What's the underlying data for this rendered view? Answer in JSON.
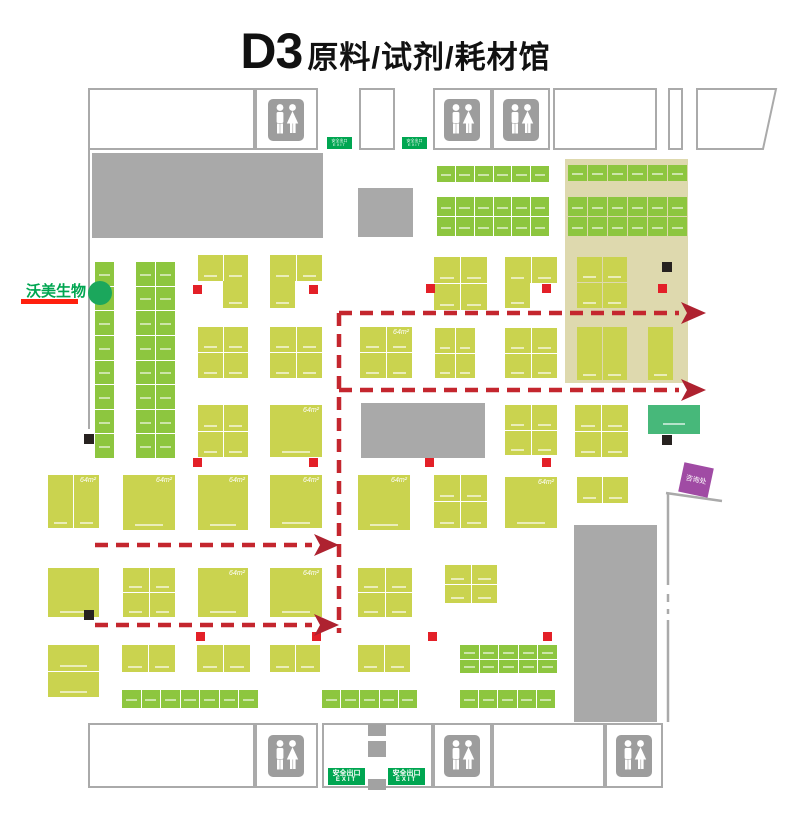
{
  "title": {
    "code": "D3",
    "name": "原料/试剂/耗材馆"
  },
  "exhibitor_marker": {
    "label": "沃美生物",
    "dot_color": "#1ba75c",
    "underline_color": "#ff200e",
    "text_color": "#00a651"
  },
  "info_booth": {
    "label": "咨询处",
    "color": "#a04ba4"
  },
  "exit_sign": {
    "line1": "安全出口",
    "line2": "EXIT",
    "color": "#00a651"
  },
  "area_label": "64m²",
  "icons": {
    "restroom": "male-female-restroom-icon"
  },
  "colors": {
    "booth_green": "#8dc63f",
    "booth_lime": "#cad34f",
    "highlight_zone": "#ded9ae",
    "structure_gray": "#a9a9a9",
    "wall": "#aaaaaa",
    "route_red": "#c4262e",
    "marker_red": "#e32028",
    "marker_black": "#272220",
    "teal_booth": "#47b87a"
  },
  "map_layout": {
    "canvas": {
      "w": 791,
      "h": 817
    },
    "outline_boxes": [
      [
        88,
        88,
        167,
        62
      ],
      [
        255,
        88,
        63,
        62
      ],
      [
        359,
        88,
        36,
        62
      ],
      [
        433,
        88,
        59,
        62
      ],
      [
        492,
        88,
        58,
        62
      ],
      [
        553,
        88,
        104,
        62
      ],
      [
        668,
        88,
        15,
        62
      ],
      [
        88,
        723,
        167,
        65
      ],
      [
        255,
        723,
        63,
        65
      ],
      [
        322,
        723,
        111,
        65
      ],
      [
        433,
        723,
        59,
        65
      ],
      [
        492,
        723,
        113,
        65
      ],
      [
        605,
        723,
        58,
        65
      ]
    ],
    "trapezoid": "697,89 776,89 763,149 697,149",
    "gray_blocks": [
      [
        92,
        153,
        231,
        85
      ],
      [
        358,
        188,
        55,
        49
      ],
      [
        361,
        403,
        124,
        55
      ],
      [
        574,
        525,
        83,
        197
      ]
    ],
    "pillars": [
      [
        368,
        724,
        18,
        12
      ],
      [
        368,
        741,
        18,
        16
      ],
      [
        368,
        779,
        18,
        11
      ]
    ],
    "highlight_zone": [
      565,
      159,
      123,
      224
    ],
    "walls": {
      "left": [
        89,
        150,
        89,
        429
      ],
      "right_solid": [
        [
          666,
          493,
          722,
          501
        ],
        [
          668,
          493,
          668,
          585
        ],
        [
          668,
          620,
          668,
          722
        ]
      ],
      "right_dashed": [
        [
          668,
          594,
          668,
          602
        ],
        [
          668,
          609,
          668,
          614
        ]
      ]
    },
    "green_grids": [
      [
        95,
        262,
        19,
        196,
        1,
        8
      ],
      [
        136,
        262,
        39,
        196,
        2,
        8
      ],
      [
        437,
        166,
        112,
        16,
        6,
        1
      ],
      [
        437,
        197,
        112,
        39,
        6,
        2
      ],
      [
        568,
        165,
        119,
        16,
        6,
        1
      ],
      [
        568,
        197,
        119,
        39,
        6,
        2
      ],
      [
        460,
        645,
        97,
        28,
        5,
        2
      ],
      [
        122,
        690,
        136,
        18,
        7,
        1
      ],
      [
        322,
        690,
        95,
        18,
        5,
        1
      ],
      [
        460,
        690,
        95,
        18,
        5,
        1
      ]
    ],
    "lime_booths": [
      [
        198,
        255,
        50,
        26,
        2,
        1,
        0
      ],
      [
        223,
        281,
        25,
        27,
        1,
        1,
        0
      ],
      [
        270,
        255,
        52,
        26,
        2,
        1,
        0
      ],
      [
        270,
        281,
        25,
        27,
        1,
        1,
        0
      ],
      [
        434,
        257,
        53,
        53,
        2,
        2,
        0
      ],
      [
        505,
        257,
        52,
        26,
        2,
        1,
        0
      ],
      [
        505,
        283,
        25,
        25,
        1,
        1,
        0
      ],
      [
        577,
        257,
        50,
        51,
        2,
        2,
        0
      ],
      [
        198,
        327,
        50,
        51,
        2,
        2,
        0
      ],
      [
        270,
        327,
        52,
        51,
        2,
        2,
        0
      ],
      [
        360,
        327,
        52,
        51,
        2,
        2,
        1
      ],
      [
        435,
        328,
        40,
        50,
        2,
        2,
        0
      ],
      [
        505,
        328,
        52,
        50,
        2,
        2,
        0
      ],
      [
        577,
        327,
        50,
        53,
        2,
        1,
        0
      ],
      [
        648,
        327,
        25,
        53,
        1,
        1,
        0
      ],
      [
        198,
        405,
        50,
        52,
        2,
        2,
        0
      ],
      [
        270,
        405,
        52,
        52,
        1,
        1,
        1
      ],
      [
        505,
        405,
        52,
        50,
        2,
        2,
        0
      ],
      [
        575,
        405,
        53,
        52,
        2,
        2,
        0
      ],
      [
        48,
        475,
        51,
        53,
        2,
        1,
        1
      ],
      [
        123,
        475,
        52,
        55,
        1,
        1,
        1
      ],
      [
        198,
        475,
        50,
        55,
        1,
        1,
        1
      ],
      [
        270,
        475,
        52,
        53,
        1,
        1,
        1
      ],
      [
        358,
        475,
        52,
        55,
        1,
        1,
        1
      ],
      [
        434,
        475,
        53,
        53,
        2,
        2,
        0
      ],
      [
        505,
        477,
        52,
        51,
        1,
        1,
        1
      ],
      [
        577,
        477,
        51,
        26,
        2,
        1,
        0
      ],
      [
        48,
        568,
        51,
        49,
        1,
        1,
        0
      ],
      [
        123,
        568,
        52,
        49,
        2,
        2,
        0
      ],
      [
        198,
        568,
        50,
        49,
        1,
        1,
        1
      ],
      [
        270,
        568,
        52,
        49,
        1,
        1,
        1
      ],
      [
        358,
        568,
        54,
        49,
        2,
        2,
        0
      ],
      [
        445,
        565,
        52,
        38,
        2,
        2,
        0
      ],
      [
        48,
        645,
        51,
        52,
        1,
        2,
        0
      ],
      [
        122,
        645,
        53,
        27,
        2,
        1,
        0
      ],
      [
        197,
        645,
        53,
        27,
        2,
        1,
        0
      ],
      [
        270,
        645,
        50,
        27,
        2,
        1,
        0
      ],
      [
        358,
        645,
        52,
        27,
        2,
        1,
        0
      ]
    ],
    "teal_booth": [
      648,
      405,
      52,
      29
    ],
    "info_booth_rect": [
      681,
      465,
      30,
      30,
      12
    ],
    "red_markers": [
      [
        193,
        285
      ],
      [
        309,
        285
      ],
      [
        426,
        284
      ],
      [
        542,
        284
      ],
      [
        658,
        284
      ],
      [
        193,
        458
      ],
      [
        309,
        458
      ],
      [
        425,
        458
      ],
      [
        542,
        458
      ],
      [
        196,
        632
      ],
      [
        312,
        632
      ],
      [
        428,
        632
      ],
      [
        543,
        632
      ]
    ],
    "black_markers": [
      [
        662,
        262
      ],
      [
        84,
        434
      ],
      [
        84,
        610
      ],
      [
        662,
        435
      ]
    ],
    "restrooms": [
      [
        286,
        120
      ],
      [
        462,
        120
      ],
      [
        521,
        120
      ],
      [
        286,
        756
      ],
      [
        462,
        756
      ],
      [
        634,
        756
      ]
    ],
    "exits": [
      {
        "x": 327,
        "y": 137,
        "w": 25,
        "h": 12,
        "size": "small"
      },
      {
        "x": 402,
        "y": 137,
        "w": 25,
        "h": 12,
        "size": "small"
      },
      {
        "x": 328,
        "y": 768,
        "w": 37,
        "h": 17,
        "size": "large"
      },
      {
        "x": 388,
        "y": 768,
        "w": 37,
        "h": 17,
        "size": "large"
      }
    ],
    "route": {
      "vertical": [
        339,
        313,
        339,
        633
      ],
      "arrows": [
        {
          "x1": 339,
          "x2": 679,
          "y": 313
        },
        {
          "x1": 339,
          "x2": 679,
          "y": 390
        },
        {
          "x1": 95,
          "x2": 312,
          "y": 545
        },
        {
          "x1": 95,
          "x2": 312,
          "y": 625
        }
      ]
    }
  }
}
